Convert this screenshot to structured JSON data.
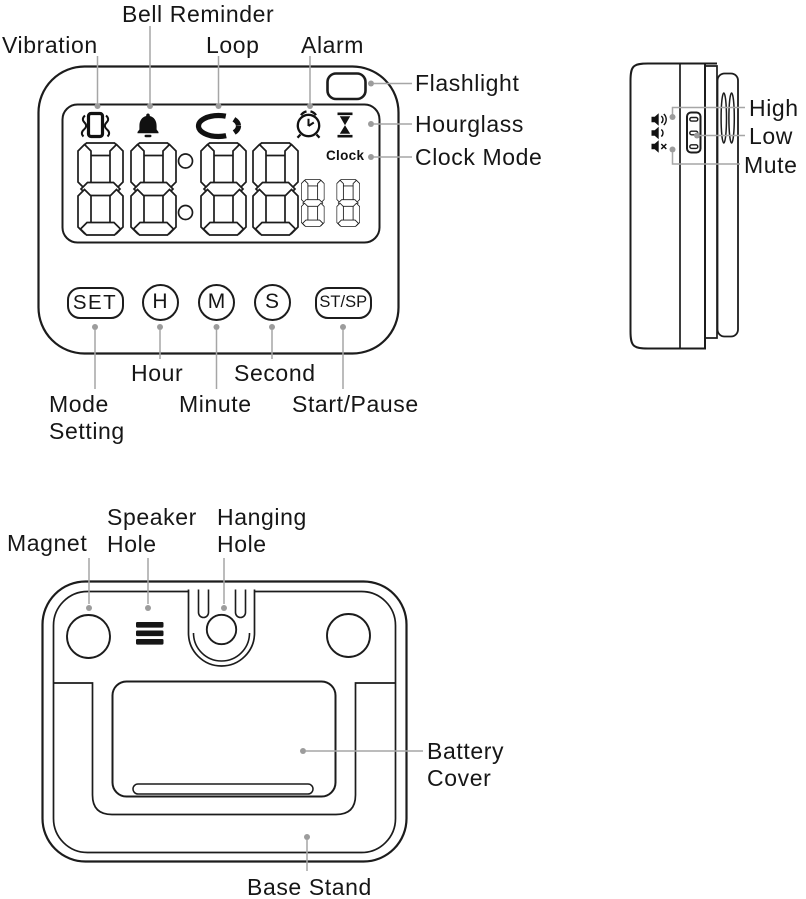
{
  "palette": {
    "outline": "#1c1c1c",
    "leader_line": "#a0a0a0",
    "text": "#161616",
    "icon_fill": "#111111"
  },
  "front_view": {
    "callouts": {
      "vibration": "Vibration",
      "bell_reminder": "Bell Reminder",
      "loop": "Loop",
      "alarm": "Alarm",
      "flashlight": "Flashlight",
      "hourglass": "Hourglass",
      "clock_mode": "Clock Mode",
      "mode_setting": "Mode Setting",
      "hour": "Hour",
      "minute": "Minute",
      "second": "Second",
      "start_pause": "Start/Pause"
    },
    "display": {
      "clock_indicator": "Clock",
      "large_digits": "88:88",
      "small_digits": "88",
      "icons": [
        "vibration-icon",
        "bell-icon",
        "loop-icon",
        "alarm-clock-icon",
        "hourglass-icon"
      ]
    },
    "buttons": {
      "set": "SET",
      "hour": "H",
      "minute": "M",
      "second": "S",
      "start_stop": "ST/SP"
    }
  },
  "side_view": {
    "callouts": {
      "high": "High",
      "low": "Low",
      "mute": "Mute"
    },
    "icons": [
      "volume-high-icon",
      "volume-low-icon",
      "volume-mute-icon"
    ]
  },
  "back_view": {
    "callouts": {
      "magnet": "Magnet",
      "speaker_hole": "Speaker Hole",
      "hanging_hole": "Hanging Hole",
      "battery_cover": "Battery Cover",
      "base_stand": "Base Stand"
    }
  }
}
